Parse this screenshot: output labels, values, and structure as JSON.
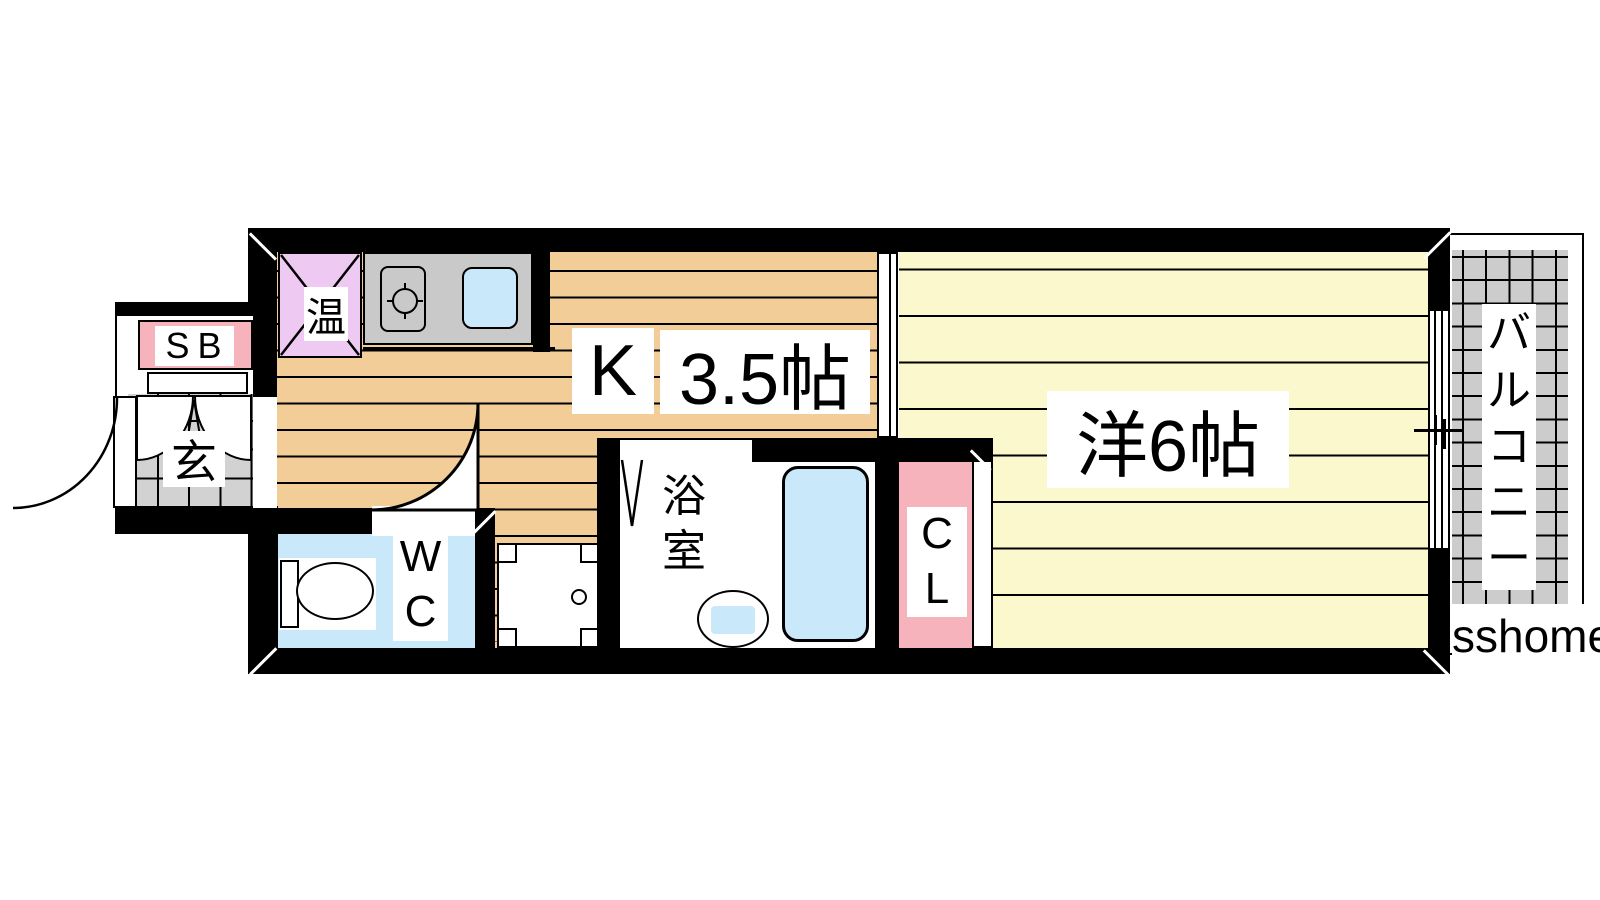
{
  "labels": {
    "shoe_box": "SB",
    "entrance": "玄",
    "water_heater": "温",
    "kitchen_k": "K",
    "kitchen_size": "3.5帖",
    "wc": "W\nC",
    "bath": "浴\n室",
    "closet": "C\nL",
    "western_room": "洋6帖",
    "balcony": "バ\nル\nコ\nニ\nー",
    "watermark": "sshome"
  },
  "colors": {
    "wall": "#000000",
    "kitchen_floor": "#f2cd97",
    "western_floor": "#fbf8cd",
    "genkan_tile": "#d2d2d2",
    "pink": "#f7b3bb",
    "lavender": "#eec9f2",
    "water_blue": "#c9e9fb",
    "counter_gray": "#c9c9c9",
    "balcony_tile": "#cccccc"
  }
}
